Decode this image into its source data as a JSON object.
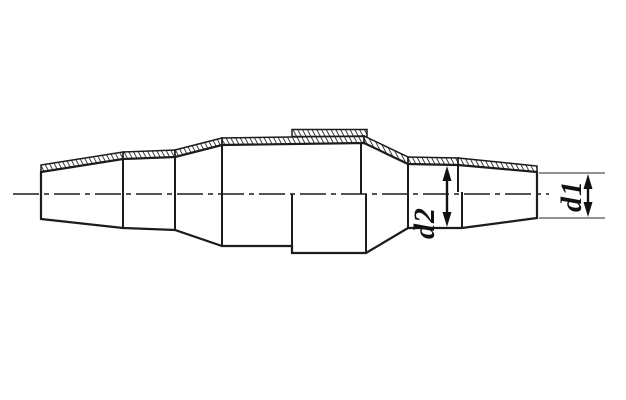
{
  "drawing": {
    "description": "Half-section technical drawing of a tapered heat-shrink cable joint sleeve with hatched top surface",
    "dimensions": {
      "d2": {
        "label": "d2"
      },
      "d1": {
        "label": "d1"
      }
    },
    "colors": {
      "line": "#1c1c1c",
      "thin_line": "#4f4f4f",
      "dimension": "#111111",
      "background": "#ffffff"
    }
  }
}
